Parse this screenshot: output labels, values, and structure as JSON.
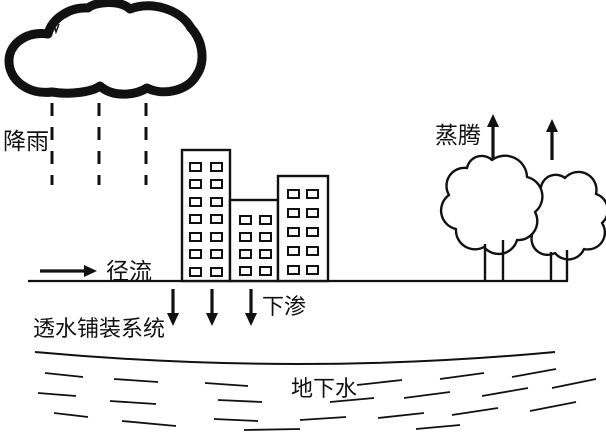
{
  "labels": {
    "rainfall": "降雨",
    "runoff": "径流",
    "infiltration": "下渗",
    "permeable_pavement_system": "透水铺装系统",
    "groundwater": "地下水",
    "transpiration": "蒸腾"
  },
  "colors": {
    "ink": "#111111",
    "background": "#ffffff"
  },
  "diagram": {
    "type": "urban-water-cycle-permeable-pavement",
    "rain_lines": [
      {
        "x": 52,
        "y1": 103,
        "y2": 185
      },
      {
        "x": 99,
        "y1": 103,
        "y2": 185
      },
      {
        "x": 146,
        "y1": 103,
        "y2": 185
      }
    ],
    "buildings": [
      {
        "x": 182,
        "y": 150,
        "w": 48,
        "h": 131,
        "window_cols_x": [
          190,
          211
        ],
        "window_rows_y": [
          163,
          180,
          198,
          215,
          233,
          250,
          268
        ],
        "window_w": 11,
        "window_h": 8
      },
      {
        "x": 230,
        "y": 200,
        "w": 48,
        "h": 81,
        "window_cols_x": [
          240,
          260
        ],
        "window_rows_y": [
          216,
          233,
          250,
          267
        ],
        "window_w": 11,
        "window_h": 8
      },
      {
        "x": 278,
        "y": 176,
        "w": 50,
        "h": 105,
        "window_cols_x": [
          288,
          307
        ],
        "window_rows_y": [
          190,
          209,
          228,
          247,
          266
        ],
        "window_w": 11,
        "window_h": 8
      }
    ],
    "ground_line": {
      "x1": 28,
      "x2": 568,
      "y": 281
    },
    "arrows": {
      "runoff": [
        {
          "x1": 40,
          "y1": 271,
          "x2": 97,
          "y2": 271
        }
      ],
      "infiltration": [
        {
          "x1": 173,
          "y1": 289,
          "x2": 173,
          "y2": 326
        },
        {
          "x1": 212,
          "y1": 289,
          "x2": 212,
          "y2": 326
        },
        {
          "x1": 251,
          "y1": 289,
          "x2": 251,
          "y2": 326
        }
      ],
      "transpiration": [
        {
          "x1": 493,
          "y1": 160,
          "x2": 493,
          "y2": 114
        },
        {
          "x1": 552,
          "y1": 160,
          "x2": 552,
          "y2": 119
        }
      ]
    },
    "water_table_curve": {
      "x1": 35,
      "y1": 352,
      "cx": 300,
      "cy": 376,
      "x2": 555,
      "y2": 352
    },
    "groundwater_dashes": [
      [
        45,
        373,
        83,
        377
      ],
      [
        114,
        379,
        158,
        382
      ],
      [
        205,
        383,
        248,
        386
      ],
      [
        357,
        385,
        402,
        380
      ],
      [
        440,
        379,
        484,
        373
      ],
      [
        512,
        377,
        556,
        369
      ],
      [
        38,
        393,
        76,
        396
      ],
      [
        110,
        401,
        156,
        404
      ],
      [
        218,
        400,
        262,
        402
      ],
      [
        330,
        402,
        374,
        398
      ],
      [
        404,
        398,
        450,
        392
      ],
      [
        482,
        396,
        528,
        388
      ],
      [
        552,
        388,
        596,
        379
      ],
      [
        54,
        413,
        88,
        417
      ],
      [
        122,
        421,
        176,
        426
      ],
      [
        214,
        419,
        258,
        421
      ],
      [
        300,
        420,
        346,
        417
      ],
      [
        378,
        418,
        424,
        413
      ],
      [
        452,
        415,
        498,
        408
      ],
      [
        530,
        411,
        576,
        402
      ],
      [
        244,
        430,
        300,
        429
      ],
      [
        416,
        429,
        460,
        425
      ]
    ]
  }
}
